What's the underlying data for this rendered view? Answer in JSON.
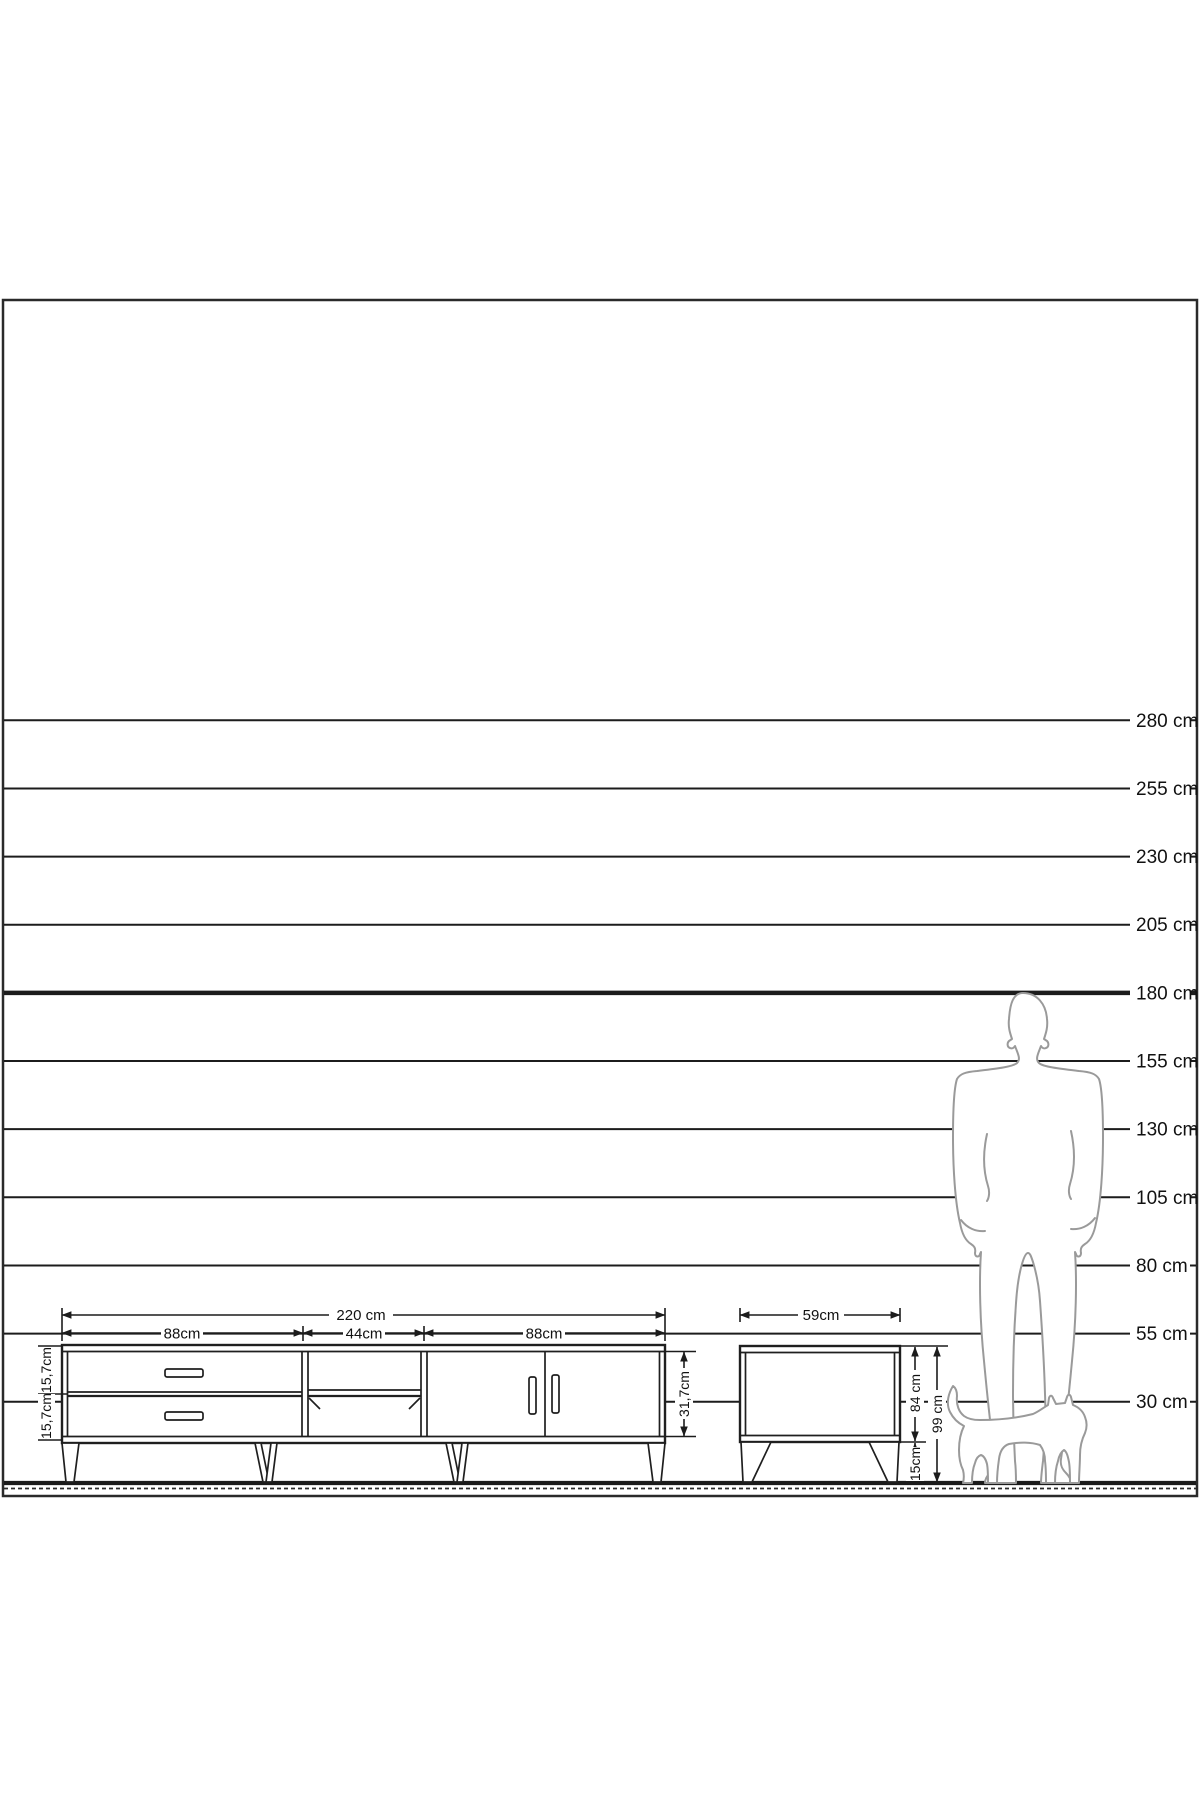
{
  "diagram_title": "furniture-height-scale-diagram",
  "scale_ruler": {
    "unit": "cm",
    "lines": [
      {
        "value_cm": 280,
        "label": "280 cm",
        "bold": false
      },
      {
        "value_cm": 255,
        "label": "255 cm",
        "bold": false
      },
      {
        "value_cm": 230,
        "label": "230 cm",
        "bold": false
      },
      {
        "value_cm": 205,
        "label": "205 cm",
        "bold": false
      },
      {
        "value_cm": 180,
        "label": "180 cm",
        "bold": true
      },
      {
        "value_cm": 155,
        "label": "155 cm",
        "bold": false
      },
      {
        "value_cm": 130,
        "label": "130 cm",
        "bold": false
      },
      {
        "value_cm": 105,
        "label": "105 cm",
        "bold": false
      },
      {
        "value_cm": 80,
        "label": "80 cm",
        "bold": false
      },
      {
        "value_cm": 55,
        "label": "55 cm",
        "bold": false
      },
      {
        "value_cm": 30,
        "label": "30 cm",
        "bold": false
      }
    ]
  },
  "tv_stand": {
    "total_width_label": "220 cm",
    "section_width_labels": [
      "88cm",
      "44cm",
      "88cm"
    ],
    "drawer_height_labels": [
      "15,7cm",
      "15,7cm"
    ],
    "carcass_height_label": "31,7cm"
  },
  "side_table": {
    "width_label": "59cm",
    "body_height_label": "84 cm",
    "leg_height_label": "15cm",
    "total_height_label": "99 cm"
  },
  "icons": {
    "person": "standing-man-silhouette",
    "cat": "walking-cat-silhouette"
  },
  "colors": {
    "line": "#1c1c1c",
    "silhouette": "#9a9a9a",
    "background": "#ffffff"
  }
}
